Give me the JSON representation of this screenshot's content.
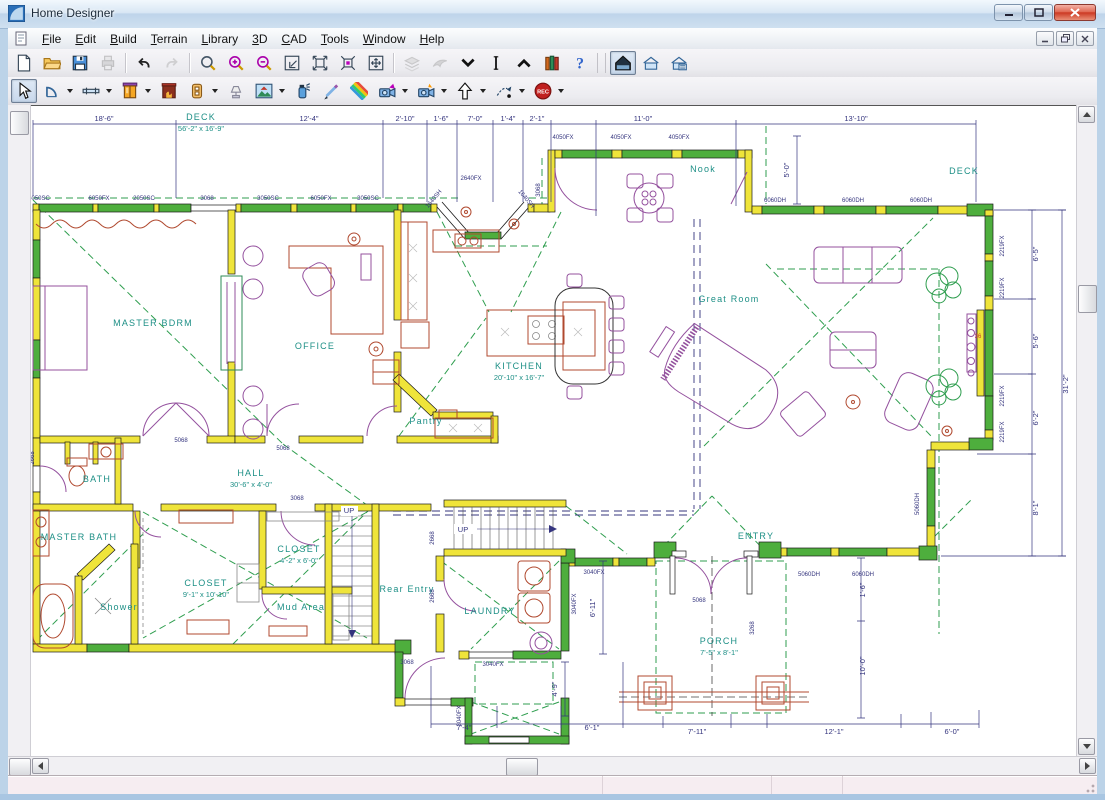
{
  "window": {
    "title": "Home Designer"
  },
  "titlebar": {
    "controls": [
      "minimize",
      "maximize",
      "close"
    ]
  },
  "menu": {
    "items": [
      "File",
      "Edit",
      "Build",
      "Terrain",
      "Library",
      "3D",
      "CAD",
      "Tools",
      "Window",
      "Help"
    ]
  },
  "mdi_controls": [
    "minimize",
    "restore",
    "close"
  ],
  "toolbars": {
    "row1": [
      {
        "icon": "new-file"
      },
      {
        "icon": "open-folder"
      },
      {
        "icon": "save"
      },
      {
        "icon": "print",
        "disabled": true
      },
      {
        "type": "sep"
      },
      {
        "icon": "undo"
      },
      {
        "icon": "redo",
        "disabled": true
      },
      {
        "type": "sep"
      },
      {
        "icon": "zoom"
      },
      {
        "icon": "zoom-in"
      },
      {
        "icon": "zoom-out"
      },
      {
        "icon": "fill-window"
      },
      {
        "icon": "expand-all"
      },
      {
        "icon": "expand-region"
      },
      {
        "icon": "pan"
      },
      {
        "type": "sep"
      },
      {
        "icon": "layers",
        "disabled": true
      },
      {
        "icon": "feather",
        "disabled": true
      },
      {
        "icon": "arrow-down"
      },
      {
        "icon": "marker"
      },
      {
        "icon": "arrow-up"
      },
      {
        "icon": "library"
      },
      {
        "icon": "help"
      },
      {
        "type": "grip"
      },
      {
        "icon": "house-overview",
        "selected": true
      },
      {
        "icon": "house-plan"
      },
      {
        "icon": "house-detail"
      }
    ],
    "row2": [
      {
        "icon": "select",
        "selected": true
      },
      {
        "icon": "door-arch",
        "dropdown": true
      },
      {
        "icon": "window-tool",
        "dropdown": true
      },
      {
        "icon": "cabinet",
        "dropdown": true
      },
      {
        "icon": "fireplace"
      },
      {
        "icon": "outlet",
        "dropdown": true
      },
      {
        "icon": "light-fixture"
      },
      {
        "icon": "image-tool",
        "dropdown": true
      },
      {
        "icon": "spray"
      },
      {
        "icon": "pencil"
      },
      {
        "icon": "materials"
      },
      {
        "icon": "camera",
        "dropdown": true
      },
      {
        "icon": "camera-flash",
        "dropdown": true
      },
      {
        "icon": "north-arrow",
        "dropdown": true
      },
      {
        "icon": "walkthrough",
        "dropdown": true
      },
      {
        "icon": "record",
        "dropdown": true
      }
    ]
  },
  "floor_plan": {
    "rooms": [
      {
        "name": "DECK",
        "size": "56'-2\" x 16'-9\"",
        "x": 170,
        "y": 14
      },
      {
        "name": "Nook",
        "x": 672,
        "y": 66
      },
      {
        "name": "DECK",
        "x": 933,
        "y": 68
      },
      {
        "name": "Great Room",
        "x": 698,
        "y": 196
      },
      {
        "name": "MASTER BDRM",
        "x": 122,
        "y": 220
      },
      {
        "name": "OFFICE",
        "x": 284,
        "y": 243
      },
      {
        "name": "KITCHEN",
        "size": "20'-10\" x 16'-7\"",
        "x": 488,
        "y": 263
      },
      {
        "name": "Pantry",
        "x": 395,
        "y": 318
      },
      {
        "name": "BATH",
        "x": 66,
        "y": 376
      },
      {
        "name": "HALL",
        "size": "30'-6\" x 4'-0\"",
        "x": 220,
        "y": 370
      },
      {
        "name": "MASTER BATH",
        "x": 48,
        "y": 434
      },
      {
        "name": "CLOSET",
        "size": "4'-2\" x 6'-0\"",
        "x": 268,
        "y": 446
      },
      {
        "name": "CLOSET",
        "size": "9'-1\" x 10'-10\"",
        "x": 175,
        "y": 480
      },
      {
        "name": "Shower",
        "x": 88,
        "y": 504
      },
      {
        "name": "Mud Area",
        "x": 270,
        "y": 504
      },
      {
        "name": "Rear Entry",
        "x": 376,
        "y": 486
      },
      {
        "name": "LAUNDRY",
        "x": 459,
        "y": 508
      },
      {
        "name": "ENTRY",
        "x": 725,
        "y": 433
      },
      {
        "name": "PORCH",
        "size": "7'-5\" x 8'-1\"",
        "x": 688,
        "y": 538
      }
    ],
    "dimensions": [
      {
        "t": "18'-6\"",
        "x": 73,
        "y": 15
      },
      {
        "t": "12'-4\"",
        "x": 278,
        "y": 15
      },
      {
        "t": "2'-10\"",
        "x": 374,
        "y": 15
      },
      {
        "t": "1'-6\"",
        "x": 410,
        "y": 15
      },
      {
        "t": "7'-0\"",
        "x": 444,
        "y": 15
      },
      {
        "t": "1'-4\"",
        "x": 477,
        "y": 15
      },
      {
        "t": "2'-1\"",
        "x": 506,
        "y": 15
      },
      {
        "t": "11'-0\"",
        "x": 612,
        "y": 15
      },
      {
        "t": "13'-10\"",
        "x": 825,
        "y": 15
      },
      {
        "t": "5'-0\"",
        "x": 758,
        "y": 64,
        "r": -90
      },
      {
        "t": "31'-2\"",
        "x": 1037,
        "y": 278,
        "r": -90
      },
      {
        "t": "6'-5\"",
        "x": 1007,
        "y": 148,
        "r": -90
      },
      {
        "t": "5'-6\"",
        "x": 1007,
        "y": 235,
        "r": -90
      },
      {
        "t": "6'-2\"",
        "x": 1007,
        "y": 312,
        "r": -90
      },
      {
        "t": "8'-1\"",
        "x": 1007,
        "y": 402,
        "r": -90
      },
      {
        "t": "1'-6\"",
        "x": 834,
        "y": 484,
        "r": -90
      },
      {
        "t": "10'-0\"",
        "x": 834,
        "y": 560,
        "r": -90
      },
      {
        "t": "6'-11\"",
        "x": 564,
        "y": 502,
        "r": -90
      },
      {
        "t": "4'-9\"",
        "x": 526,
        "y": 583,
        "r": -90
      },
      {
        "t": "7'-4\"",
        "x": 433,
        "y": 624
      },
      {
        "t": "6'-1\"",
        "x": 561,
        "y": 624
      },
      {
        "t": "7'-11\"",
        "x": 666,
        "y": 628
      },
      {
        "t": "12'-1\"",
        "x": 803,
        "y": 628
      },
      {
        "t": "6'-0\"",
        "x": 921,
        "y": 628
      },
      {
        "t": "UP",
        "x": 318,
        "y": 407
      },
      {
        "t": "UP",
        "x": 432,
        "y": 426
      }
    ],
    "window_codes": [
      {
        "t": "5050SC",
        "x": 8,
        "y": 94
      },
      {
        "t": "6050FX",
        "x": 68,
        "y": 94
      },
      {
        "t": "2050SC",
        "x": 113,
        "y": 94
      },
      {
        "t": "3068",
        "x": 176,
        "y": 94
      },
      {
        "t": "3050SC",
        "x": 237,
        "y": 94
      },
      {
        "t": "6050FX",
        "x": 290,
        "y": 94
      },
      {
        "t": "3050SC",
        "x": 337,
        "y": 94
      },
      {
        "t": "4050FX",
        "x": 532,
        "y": 33
      },
      {
        "t": "4050FX",
        "x": 590,
        "y": 33
      },
      {
        "t": "4050FX",
        "x": 648,
        "y": 33
      },
      {
        "t": "2640FX",
        "x": 440,
        "y": 74
      },
      {
        "t": "1640SH",
        "x": 404,
        "y": 94,
        "r": -50
      },
      {
        "t": "1640SH",
        "x": 494,
        "y": 94,
        "r": 50
      },
      {
        "t": "3068",
        "x": 509,
        "y": 84,
        "r": -90
      },
      {
        "t": "6060DH",
        "x": 744,
        "y": 96
      },
      {
        "t": "6060DH",
        "x": 822,
        "y": 96
      },
      {
        "t": "6060DH",
        "x": 890,
        "y": 96
      },
      {
        "t": "2219FX",
        "x": 973,
        "y": 140,
        "r": -90
      },
      {
        "t": "2219FX",
        "x": 973,
        "y": 182,
        "r": -90
      },
      {
        "t": "2219FX",
        "x": 973,
        "y": 290,
        "r": -90
      },
      {
        "t": "2219FX",
        "x": 973,
        "y": 326,
        "r": -90
      },
      {
        "t": "5060DH",
        "x": 888,
        "y": 398,
        "r": -90
      },
      {
        "t": "5060DH",
        "x": 778,
        "y": 470
      },
      {
        "t": "6060DH",
        "x": 832,
        "y": 470
      },
      {
        "t": "5068",
        "x": 668,
        "y": 496
      },
      {
        "t": "3268",
        "x": 723,
        "y": 522,
        "r": -90
      },
      {
        "t": "5068",
        "x": 150,
        "y": 336
      },
      {
        "t": "5068",
        "x": 252,
        "y": 344
      },
      {
        "t": "3068",
        "x": 266,
        "y": 394
      },
      {
        "t": "2668",
        "x": 3,
        "y": 352,
        "r": -90
      },
      {
        "t": "2668",
        "x": 403,
        "y": 432,
        "r": -90
      },
      {
        "t": "2668",
        "x": 403,
        "y": 490,
        "r": -90
      },
      {
        "t": "3040FX",
        "x": 545,
        "y": 498,
        "r": -90
      },
      {
        "t": "3040FX",
        "x": 563,
        "y": 468
      },
      {
        "t": "3040FX",
        "x": 462,
        "y": 560
      },
      {
        "t": "3040FX",
        "x": 430,
        "y": 610,
        "r": -90
      },
      {
        "t": "3068",
        "x": 376,
        "y": 558
      },
      {
        "t": "36",
        "x": 947,
        "y": 232,
        "c": "red"
      }
    ]
  },
  "status_bar": {
    "sections": [
      "",
      "",
      "",
      ""
    ]
  },
  "colors": {
    "wall_yellow": "#efe43a",
    "window_green": "#4eae3d",
    "label_teal": "#1d8f86",
    "dim_navy": "#34347e",
    "furniture_purple": "#94519e",
    "fixture_red": "#b0492f",
    "dashed_green": "#2f9e4f",
    "titlebar_blue": "#bdd4ea",
    "close_red": "#cc3a24"
  }
}
